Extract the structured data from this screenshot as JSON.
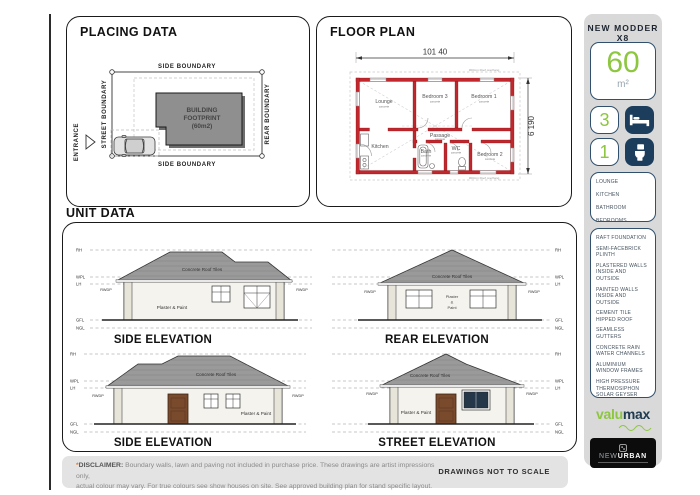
{
  "colors": {
    "accent_green": "#8dc63f",
    "navy": "#1d3d5c",
    "wall_red": "#c1272d"
  },
  "placing": {
    "title": "PLACING DATA",
    "entrance": "ENTRANCE",
    "boundary_top": "SIDE BOUNDARY",
    "boundary_bottom": "SIDE BOUNDARY",
    "boundary_left": "STREET BOUNDARY",
    "boundary_right": "REAR BOUNDARY",
    "footprint": [
      "BUILDING",
      "FOOTPRINT",
      "(60m2)"
    ]
  },
  "floorplan": {
    "title": "FLOOR PLAN",
    "width_dim": "101 40",
    "height_dim": "6 190",
    "overhang": "300mm Roof overhang",
    "rooms": [
      {
        "name": "Lounge",
        "sub": "concrete"
      },
      {
        "name": "Bedroom 3",
        "sub": "concrete"
      },
      {
        "name": "Bedroom 1",
        "sub": "concrete"
      },
      {
        "name": "Kitchen",
        "sub": ""
      },
      {
        "name": "Passage",
        "sub": "concrete"
      },
      {
        "name": "Bath",
        "sub": "concrete"
      },
      {
        "name": "WC",
        "sub": "concrete"
      },
      {
        "name": "Bedroom 2",
        "sub": "concrete"
      }
    ]
  },
  "sidebar": {
    "model": "NEW MODDER X8",
    "area_value": "60",
    "area_unit": "m²",
    "bedrooms": "3",
    "bathrooms": "1",
    "rooms": [
      "LOUNGE",
      "KITCHEN",
      "BATHROOM",
      "BEDROOMS"
    ],
    "features": [
      "RAFT FOUNDATION",
      "SEMI-FACEBRICK PLINTH",
      "PLASTERED WALLS INSIDE AND OUTSIDE",
      "PAINTED WALLS INSIDE AND OUTSIDE",
      "CEMENT TILE HIPPED ROOF",
      "SEAMLESS GUTTERS",
      "CONCRETE RAIN WATER CHANNELS",
      "ALUMINIUM WINDOW FRAMES",
      "HIGH PRESSURE THERMOSIPHON SOLAR GEYSER"
    ],
    "brand_valu": "valu",
    "brand_max": "max",
    "brand_new": "NEW",
    "brand_urban": "URBAN"
  },
  "unit": {
    "title": "UNIT DATA",
    "levels": [
      "RH",
      "WPL",
      "LH",
      "GFL",
      "NGL"
    ],
    "roof_label": "Concrete Roof Tiles",
    "wall_label": "Plaster & Paint",
    "wall_lines": [
      "Plaster",
      "&",
      "Paint"
    ],
    "rwdp": "RWDP",
    "captions": [
      "SIDE ELEVATION",
      "REAR ELEVATION",
      "SIDE ELEVATION",
      "STREET ELEVATION"
    ]
  },
  "footer": {
    "asterisk": "*",
    "label": "DISCLAIMER:",
    "line1": "Boundary walls, lawn and paving not included in purchase price. These drawings are artist impressions only,",
    "line2": "actual colour may vary. For true colours see show houses on site. See approved building plan for stand specific layout.",
    "scale": "DRAWINGS NOT TO SCALE"
  }
}
